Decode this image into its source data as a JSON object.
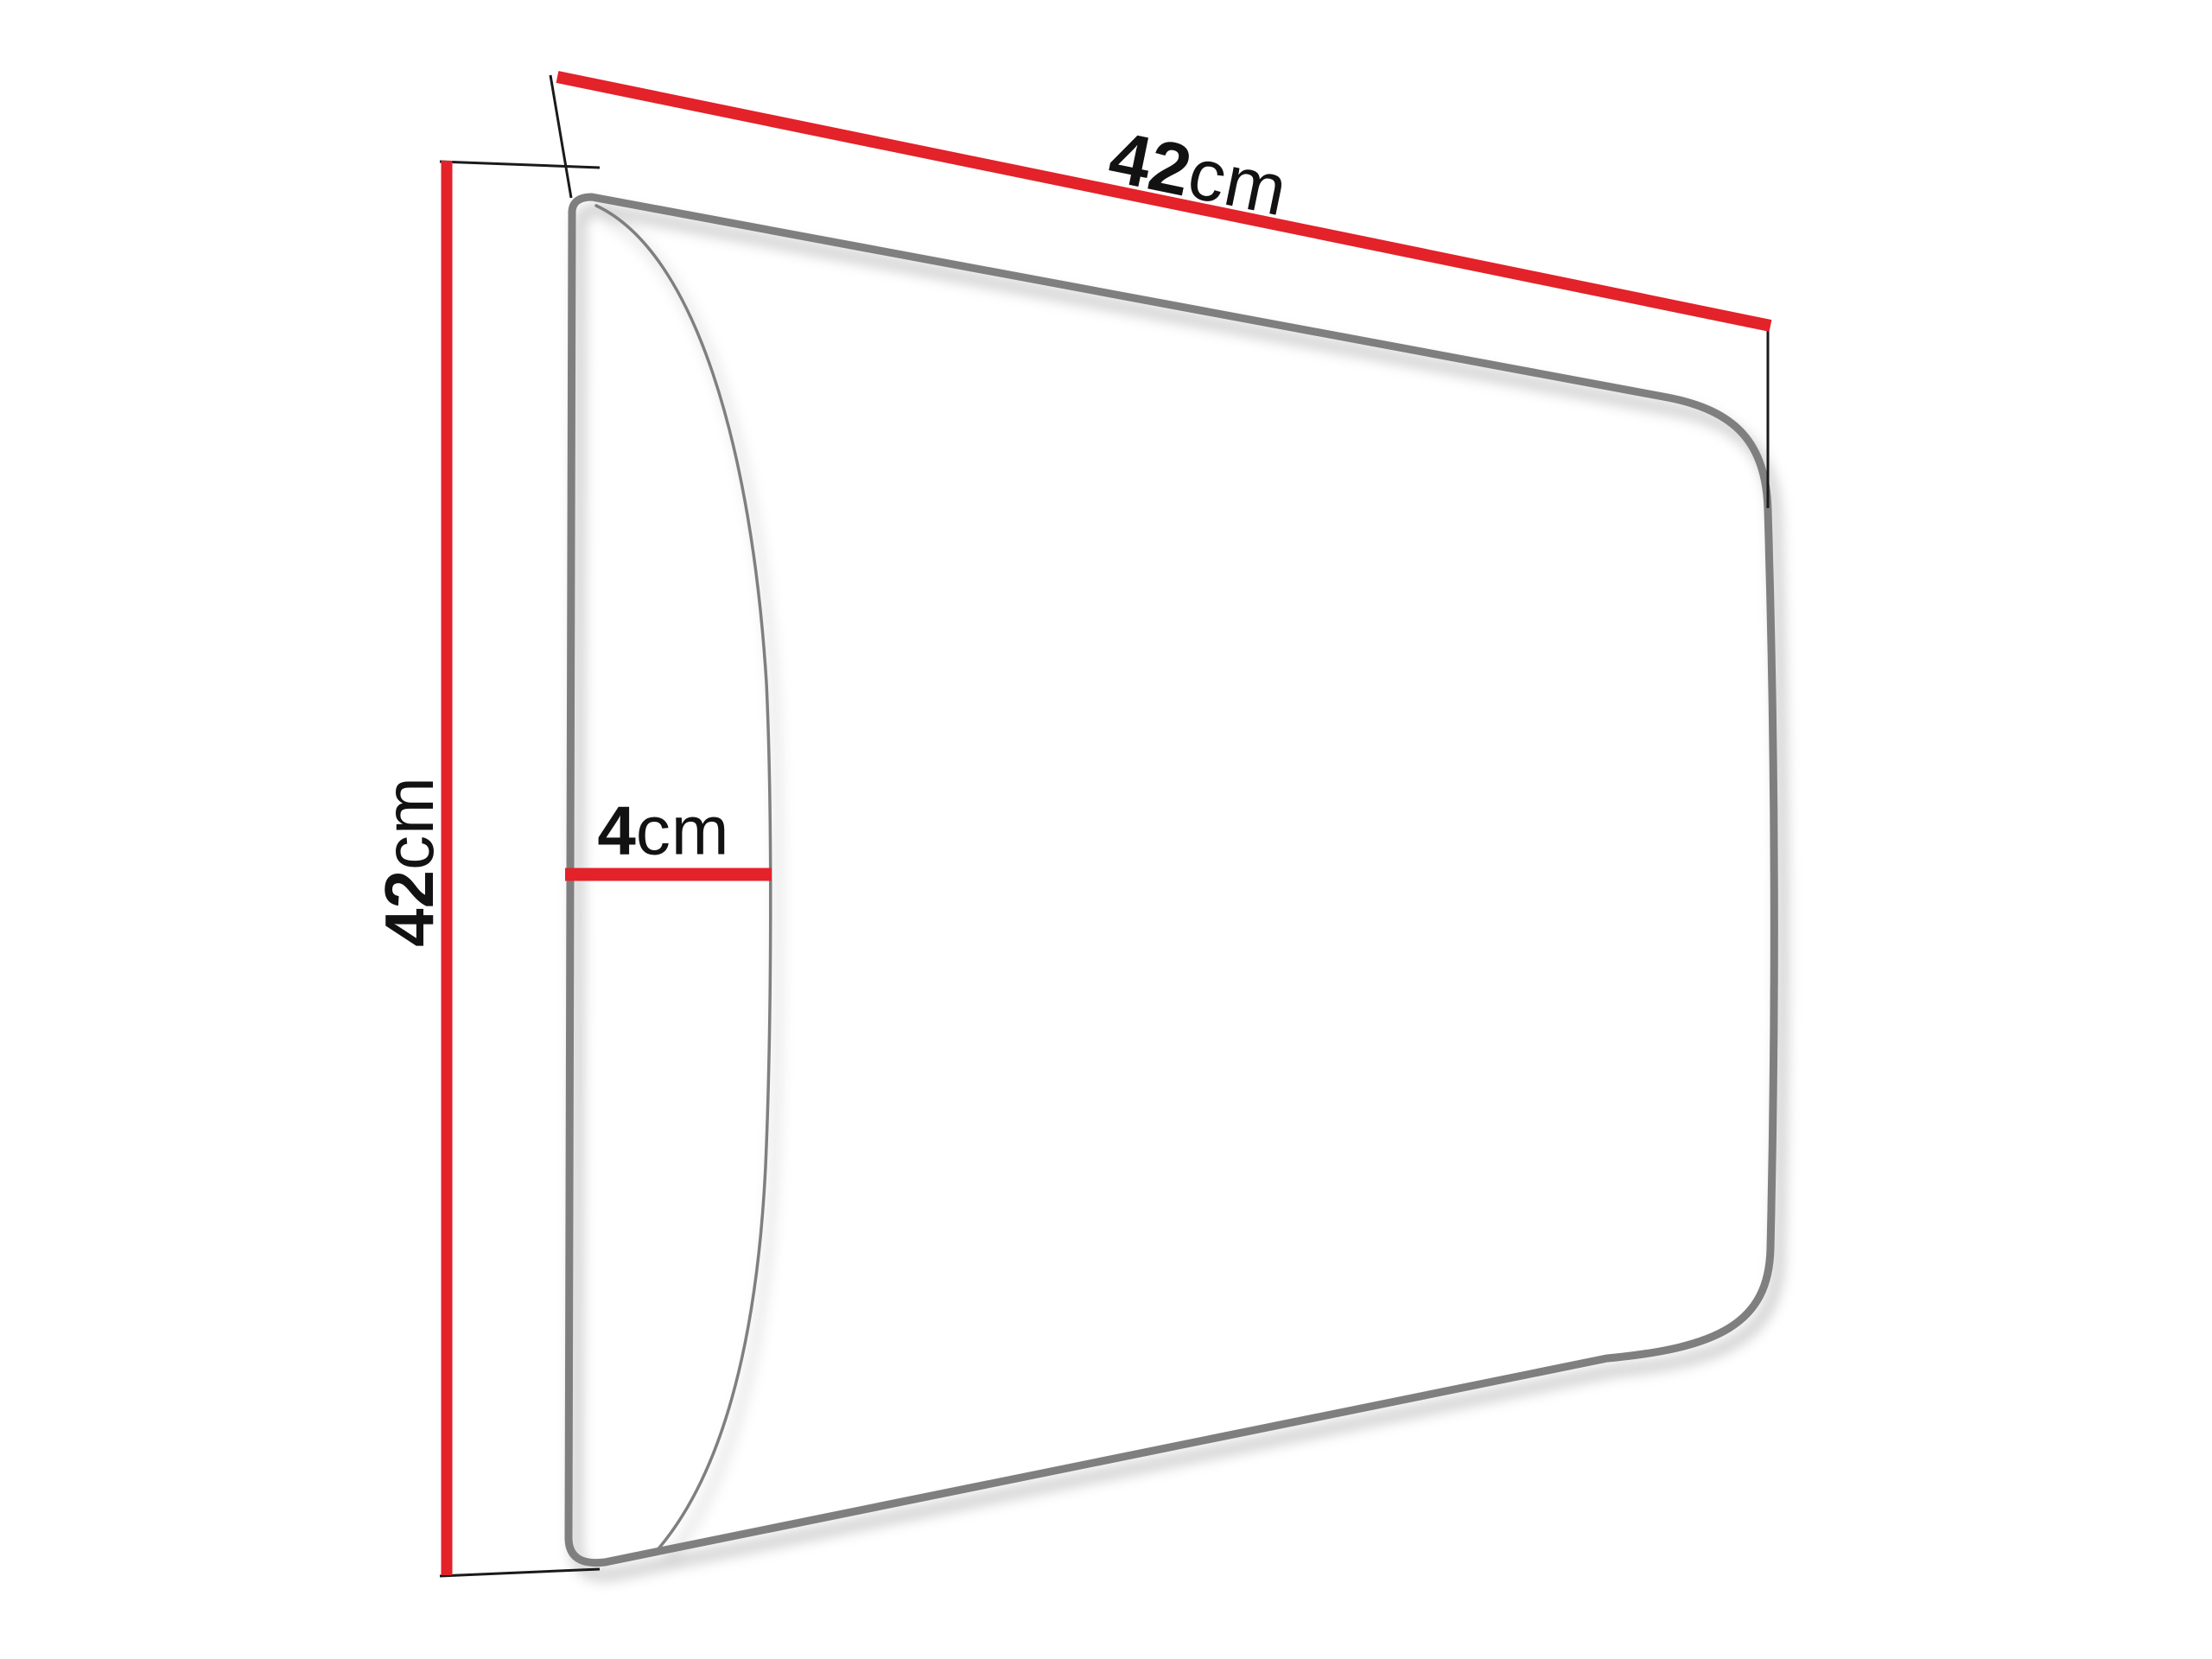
{
  "dimensions": {
    "width": {
      "value": "42",
      "unit": "cm"
    },
    "height": {
      "value": "42",
      "unit": "cm"
    },
    "depth": {
      "value": "4",
      "unit": "cm"
    }
  },
  "colors": {
    "dimension_line": "#e32229",
    "panel_outline": "#7f7f7f",
    "extension_line": "#1a1a1a",
    "label_text": "#121212",
    "background": "#ffffff"
  }
}
